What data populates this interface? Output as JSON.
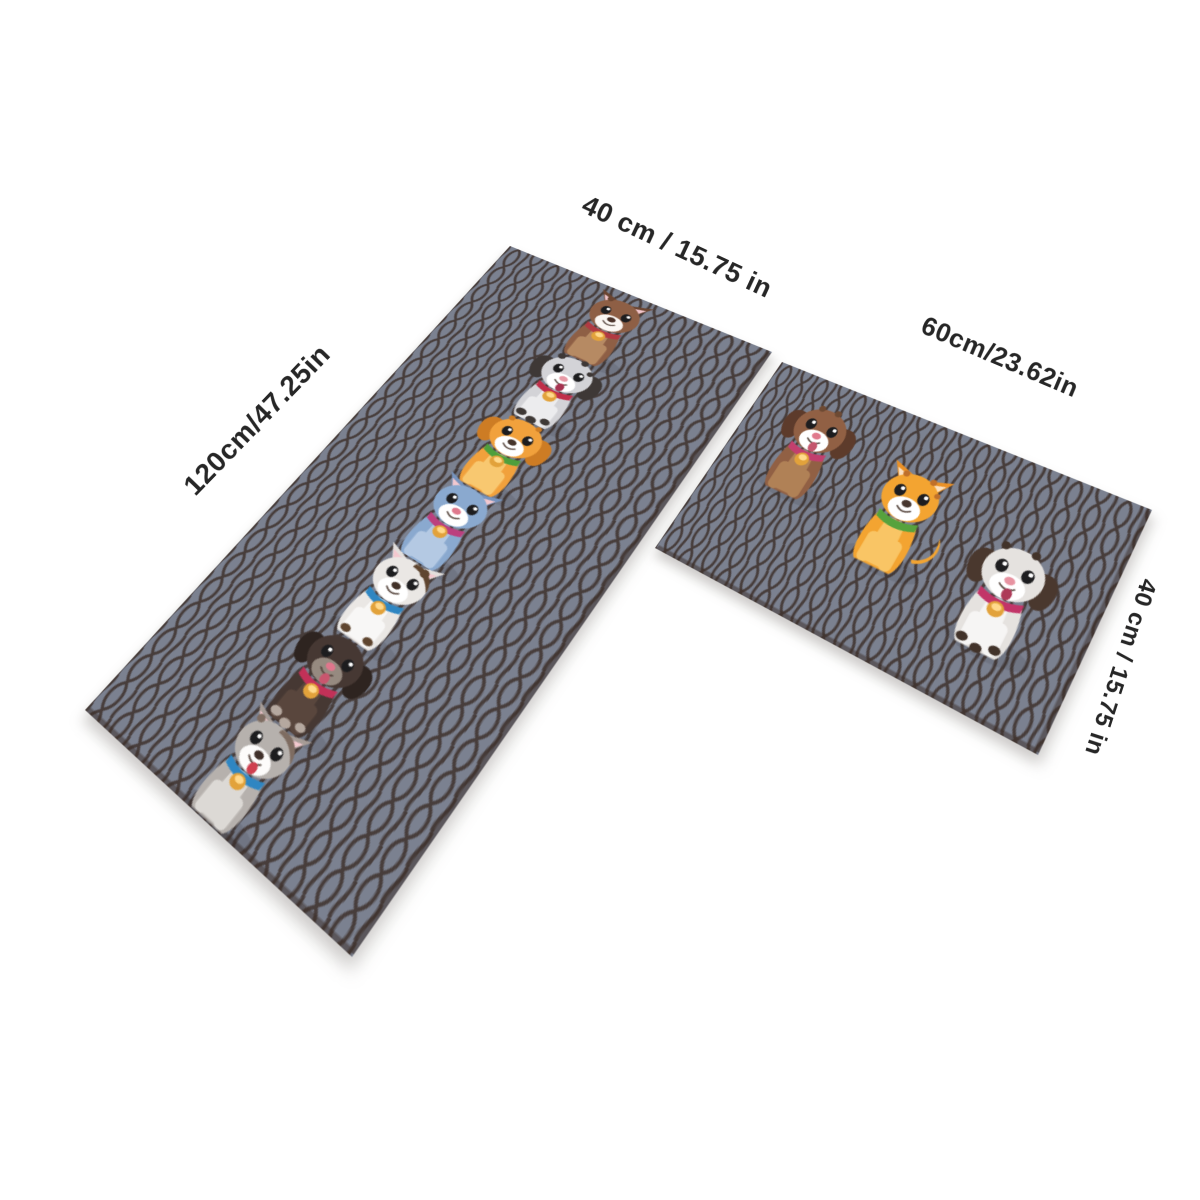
{
  "scene": {
    "background_color": "#ffffff",
    "description": "Product dimension view of a 2-piece cartoon puppy kitchen mat set laid in perspective on a white background"
  },
  "labels": [
    {
      "id": "runner-width",
      "text": "40 cm / 15.75 in"
    },
    {
      "id": "runner-length",
      "text": "120cm/47.25in"
    },
    {
      "id": "square-width",
      "text": "60cm/23.62in"
    },
    {
      "id": "square-height",
      "text": "40 cm / 15.75 in"
    }
  ],
  "palette": {
    "label_text": "#262626",
    "mat_base": "#7b8190",
    "mat_pattern": "#392b25",
    "mat_edge": "#3b2e27",
    "tag_gold": "#e2a23b",
    "tag_gold_light": "#ffd98c"
  },
  "mats": [
    {
      "id": "runner",
      "dog_count": 7
    },
    {
      "id": "square",
      "dog_count": 3
    }
  ],
  "dogs": [
    {
      "name": "dog-brown-puppy",
      "mat": "runner",
      "x": 93.5,
      "y": 5,
      "scale": 0.93,
      "ears": "pointy",
      "tag": true,
      "spots": [
        [
          35,
          11,
          3.5
        ]
      ],
      "colors": {
        "body": "#8e5f45",
        "chest": "#b68a63",
        "ear": "#6b4531",
        "muzzle": "#fbf7f3",
        "nose": "#4a332a",
        "collar": "#b13a42"
      }
    },
    {
      "name": "dog-dalmatian-puppy",
      "mat": "runner",
      "x": 93.5,
      "y": 97.5,
      "scale": 0.93,
      "ears": "floppy",
      "tag": true,
      "spots": [
        [
          33,
          12,
          4
        ],
        [
          58,
          9,
          3.8
        ],
        [
          69,
          19,
          3.2
        ]
      ],
      "paw_spots": [
        [
          37,
          99,
          5.5
        ],
        [
          50,
          103,
          5.5
        ],
        [
          63,
          98,
          5
        ]
      ],
      "colors": {
        "body": "#d3d3d7",
        "chest": "#ececee",
        "ear": "#3e3836",
        "muzzle": "#ffffff",
        "nose": "#e79aa6",
        "collar": "#c02f4a",
        "tongue": "#a63350"
      }
    },
    {
      "name": "dog-orange-puppy",
      "mat": "runner",
      "x": 93.5,
      "y": 190,
      "scale": 0.93,
      "ears": "floppy",
      "tag": true,
      "spots": [
        [
          34,
          12,
          3.2
        ],
        [
          63,
          10,
          3.2
        ]
      ],
      "colors": {
        "body": "#f1a13c",
        "chest": "#f8c870",
        "ear": "#cd7c24",
        "muzzle": "#ffffff",
        "nose": "#46352c",
        "collar": "#4f9f3c"
      }
    },
    {
      "name": "cat-blue",
      "mat": "runner",
      "x": 93.5,
      "y": 282.5,
      "scale": 0.93,
      "ears": "pointy",
      "tag": true,
      "colors": {
        "body": "#8aa9cf",
        "chest": "#b4c9e3",
        "ear": "#7693bd",
        "inner": "#f3c8cf",
        "muzzle": "#ffffff",
        "nose": "#df798d",
        "collar": "#bc3f7e"
      }
    },
    {
      "name": "dog-white-patch",
      "mat": "runner",
      "x": 93.5,
      "y": 375,
      "scale": 0.93,
      "ears": "pointy",
      "tag": true,
      "patch": true,
      "spots": [
        [
          64,
          13,
          4.5
        ]
      ],
      "paw_spots": [
        [
          38,
          100,
          5
        ],
        [
          62,
          99,
          5
        ]
      ],
      "colors": {
        "body": "#eae7e4",
        "chest": "#f8f7f6",
        "ear": "#e3dfdc",
        "inner": "#f3c8cf",
        "muzzle": "#ffffff",
        "nose": "#413128",
        "collar": "#2f86c2",
        "spot": "#5f452f"
      }
    },
    {
      "name": "dog-black-puppy",
      "mat": "runner",
      "x": 93.5,
      "y": 467.5,
      "scale": 0.93,
      "ears": "floppy",
      "tag": true,
      "paw_spots": [
        [
          37,
          99,
          5.5
        ],
        [
          50,
          103,
          5.5
        ],
        [
          63,
          98,
          5
        ]
      ],
      "colors": {
        "body": "#463833",
        "chest": "#59463d",
        "ear": "#2e2420",
        "muzzle": "#968a80",
        "nose": "#e0768c",
        "collar": "#c23158",
        "tongue": "#c9566e",
        "spot": "#b5a89f"
      }
    },
    {
      "name": "dog-gray-husky",
      "mat": "runner",
      "x": 93.5,
      "y": 560,
      "scale": 0.93,
      "ears": "pointy",
      "tag": true,
      "patch": true,
      "spots": [
        [
          31,
          13,
          3.8
        ]
      ],
      "colors": {
        "body": "#b6b1ad",
        "chest": "#dcd9d5",
        "ear": "#a69c96",
        "inner": "#f3c8cf",
        "muzzle": "#fdfcfb",
        "nose": "#40302a",
        "collar": "#2f86c2",
        "tongue": "#cf404f",
        "spot": "#7e6c61"
      }
    },
    {
      "name": "dog-brown-floppy",
      "mat": "square",
      "x": 28,
      "y": 24,
      "scale": 1.08,
      "ears": "floppy",
      "tag": true,
      "spots": [
        [
          40,
          9,
          3.5
        ],
        [
          57,
          8,
          3.5
        ]
      ],
      "colors": {
        "body": "#916044",
        "chest": "#b08156",
        "ear": "#5d3b2b",
        "muzzle": "#ffffff",
        "nose": "#e0798c",
        "collar": "#c23f6e",
        "tongue": "#c4566d",
        "spot": "#6e4a33"
      }
    },
    {
      "name": "cat-orange",
      "mat": "square",
      "x": 146,
      "y": 52,
      "scale": 1.08,
      "ears": "pointy",
      "tag": false,
      "tail": true,
      "spots": [
        [
          36,
          11,
          3.2
        ],
        [
          62,
          9,
          3.2
        ],
        [
          71,
          20,
          2.8
        ]
      ],
      "colors": {
        "body": "#f3a431",
        "chest": "#f9c565",
        "ear": "#ea9127",
        "inner": "#fbe1c2",
        "muzzle": "#ffffff",
        "nose": "#47362e",
        "collar": "#56a23d",
        "spot": "#c0702a"
      }
    },
    {
      "name": "dog-white-spots",
      "mat": "square",
      "x": 264,
      "y": 80,
      "scale": 1.08,
      "ears": "floppy",
      "tag": true,
      "spots": [
        [
          34,
          10,
          3.8
        ],
        [
          60,
          8,
          3.8
        ]
      ],
      "paw_spots": [
        [
          36,
          100,
          5
        ],
        [
          50,
          104,
          5
        ],
        [
          64,
          99,
          5
        ]
      ],
      "colors": {
        "body": "#e5e2df",
        "chest": "#f6f5f4",
        "ear": "#4a382e",
        "muzzle": "#ffffff",
        "nose": "#e793a1",
        "collar": "#c23568",
        "tongue": "#ad3a58",
        "spot": "#42332a"
      }
    }
  ]
}
